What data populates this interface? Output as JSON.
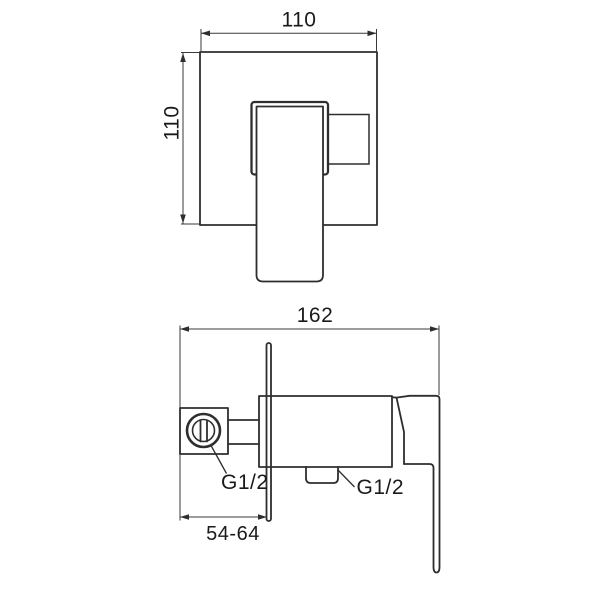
{
  "title": "Concealed shower mixer valve - dimensioned technical drawing",
  "colors": {
    "background": "#ffffff",
    "object_line": "#2e2e2e",
    "dimension_line": "#3a3a3a",
    "text": "#1a1a1a"
  },
  "views": {
    "front": {
      "name": "front view (wall plate with lever handle)",
      "dimensions": {
        "width_mm": {
          "label": "110"
        },
        "height_mm": {
          "label": "110"
        }
      }
    },
    "side": {
      "name": "side view (valve body, wall plate edge, lever)",
      "dimensions": {
        "length_mm": {
          "label": "162"
        },
        "install_depth_mm": {
          "label": "54-64"
        }
      },
      "connections": {
        "inlet_thread": {
          "label": "G1/2"
        },
        "outlet_thread": {
          "label": "G1/2"
        }
      }
    }
  }
}
